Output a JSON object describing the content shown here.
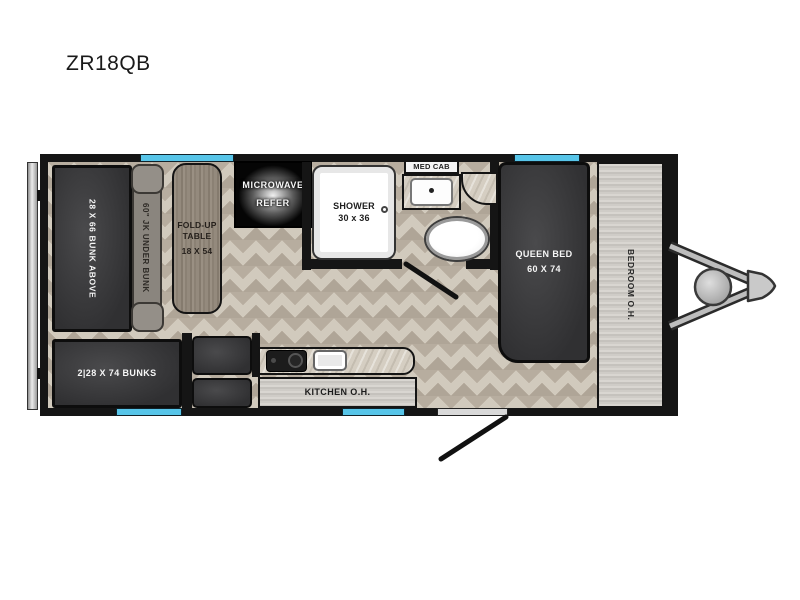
{
  "title": "ZR18QB",
  "floorplan": {
    "bunk_above_label": "28 X 66 BUNK ABOVE",
    "sofa_label": "60\" JK UNDER BUNK",
    "table_label": [
      "FOLD-UP",
      "TABLE",
      "18 X 54"
    ],
    "appliance_labels": [
      "MICROWAVE",
      "REFER"
    ],
    "shower_label": [
      "SHOWER",
      "30 x 36"
    ],
    "med_cab_label": "MED CAB",
    "queen_bed_label": [
      "QUEEN BED",
      "60 X 74"
    ],
    "bedroom_oh_label": "BEDROOM O.H.",
    "bunks_label": "2|28 X 74 BUNKS",
    "kitchen_oh_label": "KITCHEN O.H.",
    "colors": {
      "wall": "#151515",
      "window_accent": "#57c5e9",
      "dark_furniture": "#3a3a3c",
      "floor": "#c9c1b4",
      "metal_panel": "#ccc9c4",
      "table_wood": "#8f8578"
    }
  }
}
